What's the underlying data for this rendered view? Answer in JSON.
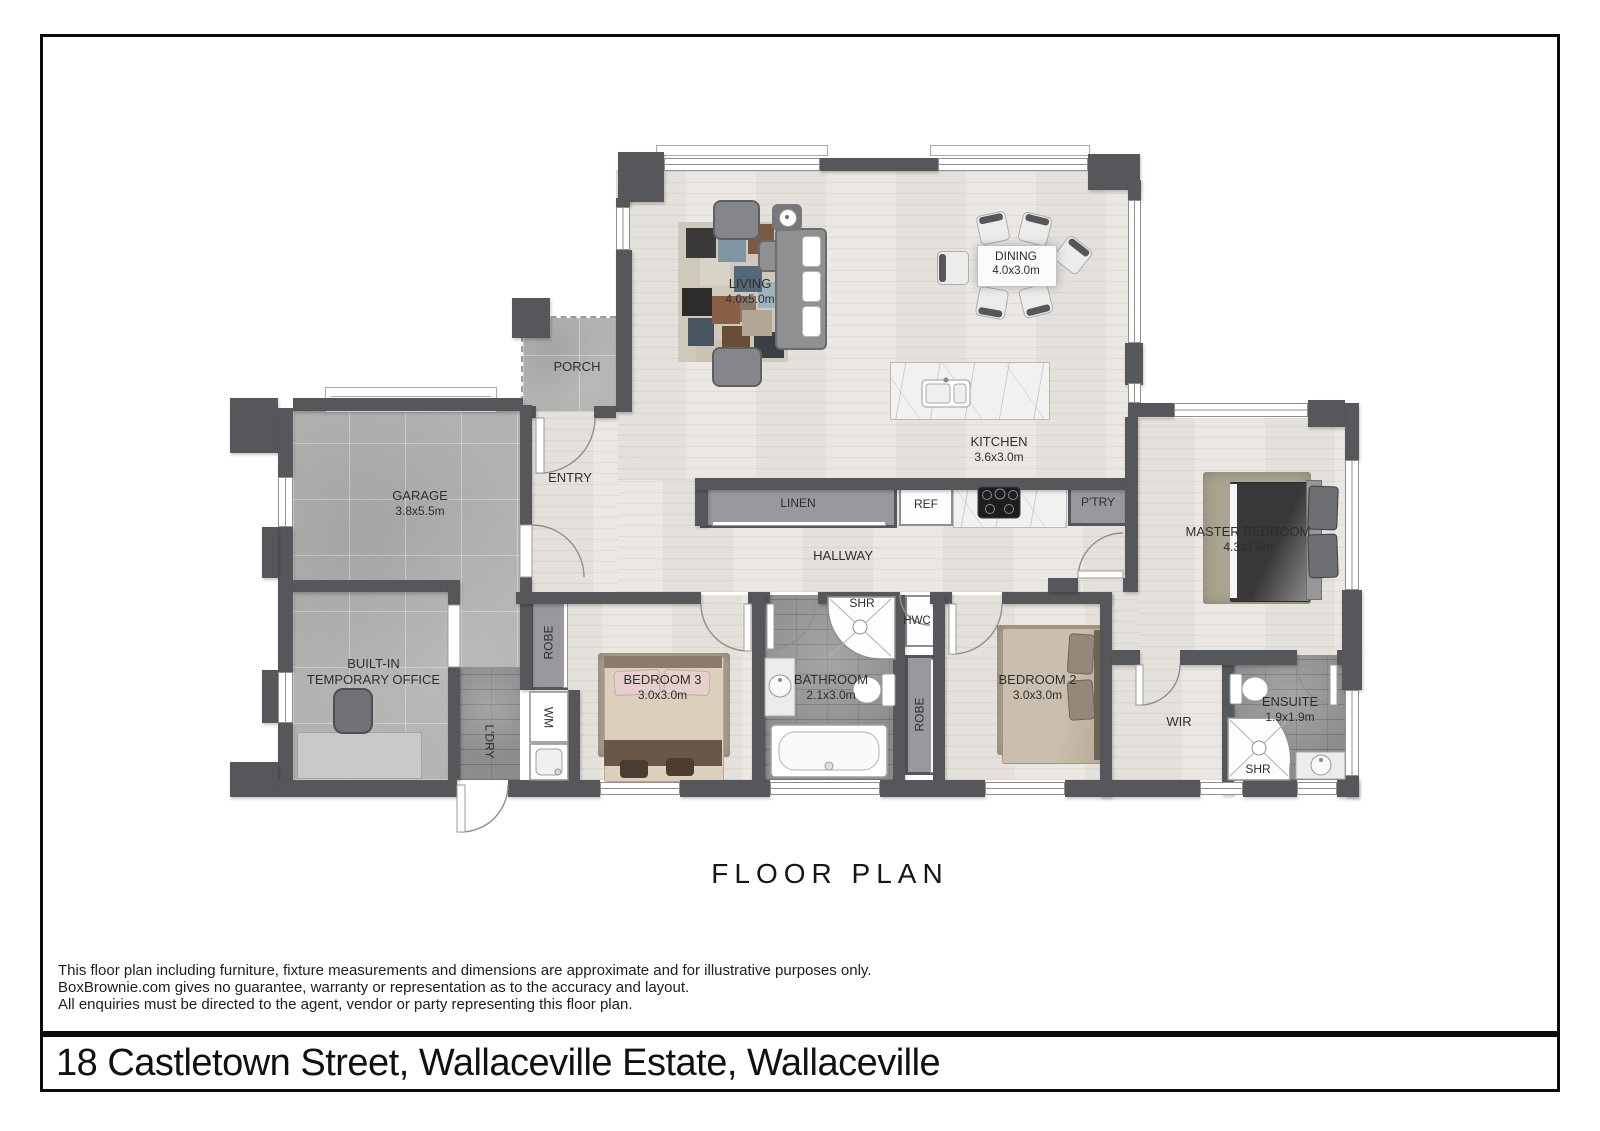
{
  "page": {
    "title": "FLOOR PLAN",
    "address": "18 Castletown Street, Wallaceville Estate, Wallaceville",
    "disclaimer_line1": "This floor plan including furniture, fixture measurements and dimensions are approximate and for illustrative purposes only.",
    "disclaimer_line2": "BoxBrownie.com gives no guarantee, warranty or representation as to the accuracy and layout.",
    "disclaimer_line3": "All enquiries must be directed to the agent, vendor or party representing this floor plan."
  },
  "rooms": {
    "living": {
      "name": "LIVING",
      "dim": "4.0x5.0m"
    },
    "dining": {
      "name": "DINING",
      "dim": "4.0x3.0m"
    },
    "kitchen": {
      "name": "KITCHEN",
      "dim": "3.6x3.0m"
    },
    "porch": {
      "name": "PORCH"
    },
    "entry": {
      "name": "ENTRY"
    },
    "garage": {
      "name": "GARAGE",
      "dim": "3.8x5.5m"
    },
    "office": {
      "line1": "BUILT-IN",
      "line2": "TEMPORARY OFFICE"
    },
    "hallway": {
      "name": "HALLWAY"
    },
    "master": {
      "name": "MASTER BEDROOM",
      "dim": "4.3x3.9m"
    },
    "bedroom2": {
      "name": "BEDROOM 2",
      "dim": "3.0x3.0m"
    },
    "bedroom3": {
      "name": "BEDROOM 3",
      "dim": "3.0x3.0m"
    },
    "bathroom": {
      "name": "BATHROOM",
      "dim": "2.1x3.0m"
    },
    "ensuite": {
      "name": "ENSUITE",
      "dim": "1.9x1.9m"
    },
    "wir": {
      "name": "WIR"
    }
  },
  "fixtures": {
    "linen": "LINEN",
    "ref": "REF",
    "pantry": "P'TRY",
    "shower_bathroom": "SHR",
    "shower_ensuite": "SHR",
    "hwc": "HWC",
    "robe_bedroom3": "ROBE",
    "robe_bedroom2": "ROBE",
    "laundry": "L'DRY",
    "washing_machine": "WM"
  },
  "colors": {
    "wall": "#56575A",
    "wood_floor": "#E9E6E1",
    "concrete_floor": "#B3B2B1",
    "dark_tile": "#8D8D8D",
    "cabinet": "#97999C",
    "marble": "#F1F1EF",
    "label_text": "#2E2E30"
  }
}
